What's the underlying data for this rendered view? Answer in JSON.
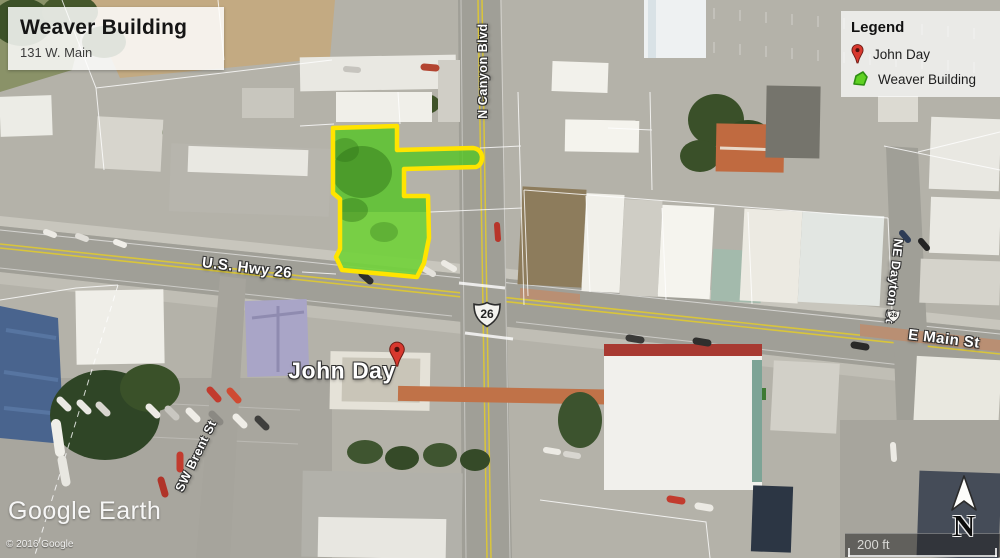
{
  "title_card": {
    "title": "Weaver Building",
    "subtitle": "131 W. Main"
  },
  "legend": {
    "header": "Legend",
    "items": [
      {
        "icon": "red-pin",
        "label": "John Day"
      },
      {
        "icon": "green-parcel",
        "label": "Weaver Building"
      }
    ]
  },
  "street_labels": {
    "highway": "U.S. Hwy 26",
    "canyon_blvd": "N Canyon Blvd",
    "main_st": "E Main St",
    "dayton_st": "NE Dayton St",
    "brent_st": "SW Brent St"
  },
  "placemark": {
    "label": "John Day"
  },
  "route_shield": {
    "number": "26"
  },
  "attribution": {
    "logo": "Google Earth",
    "copyright": "© 2016 Google"
  },
  "scale_bar": {
    "label": "200 ft"
  },
  "compass": {
    "label": "N"
  },
  "colors": {
    "parcel_fill": "#55c526",
    "parcel_outline": "#ffe400",
    "pin_red": "#d8382e",
    "road_gray": "#a09f97"
  }
}
